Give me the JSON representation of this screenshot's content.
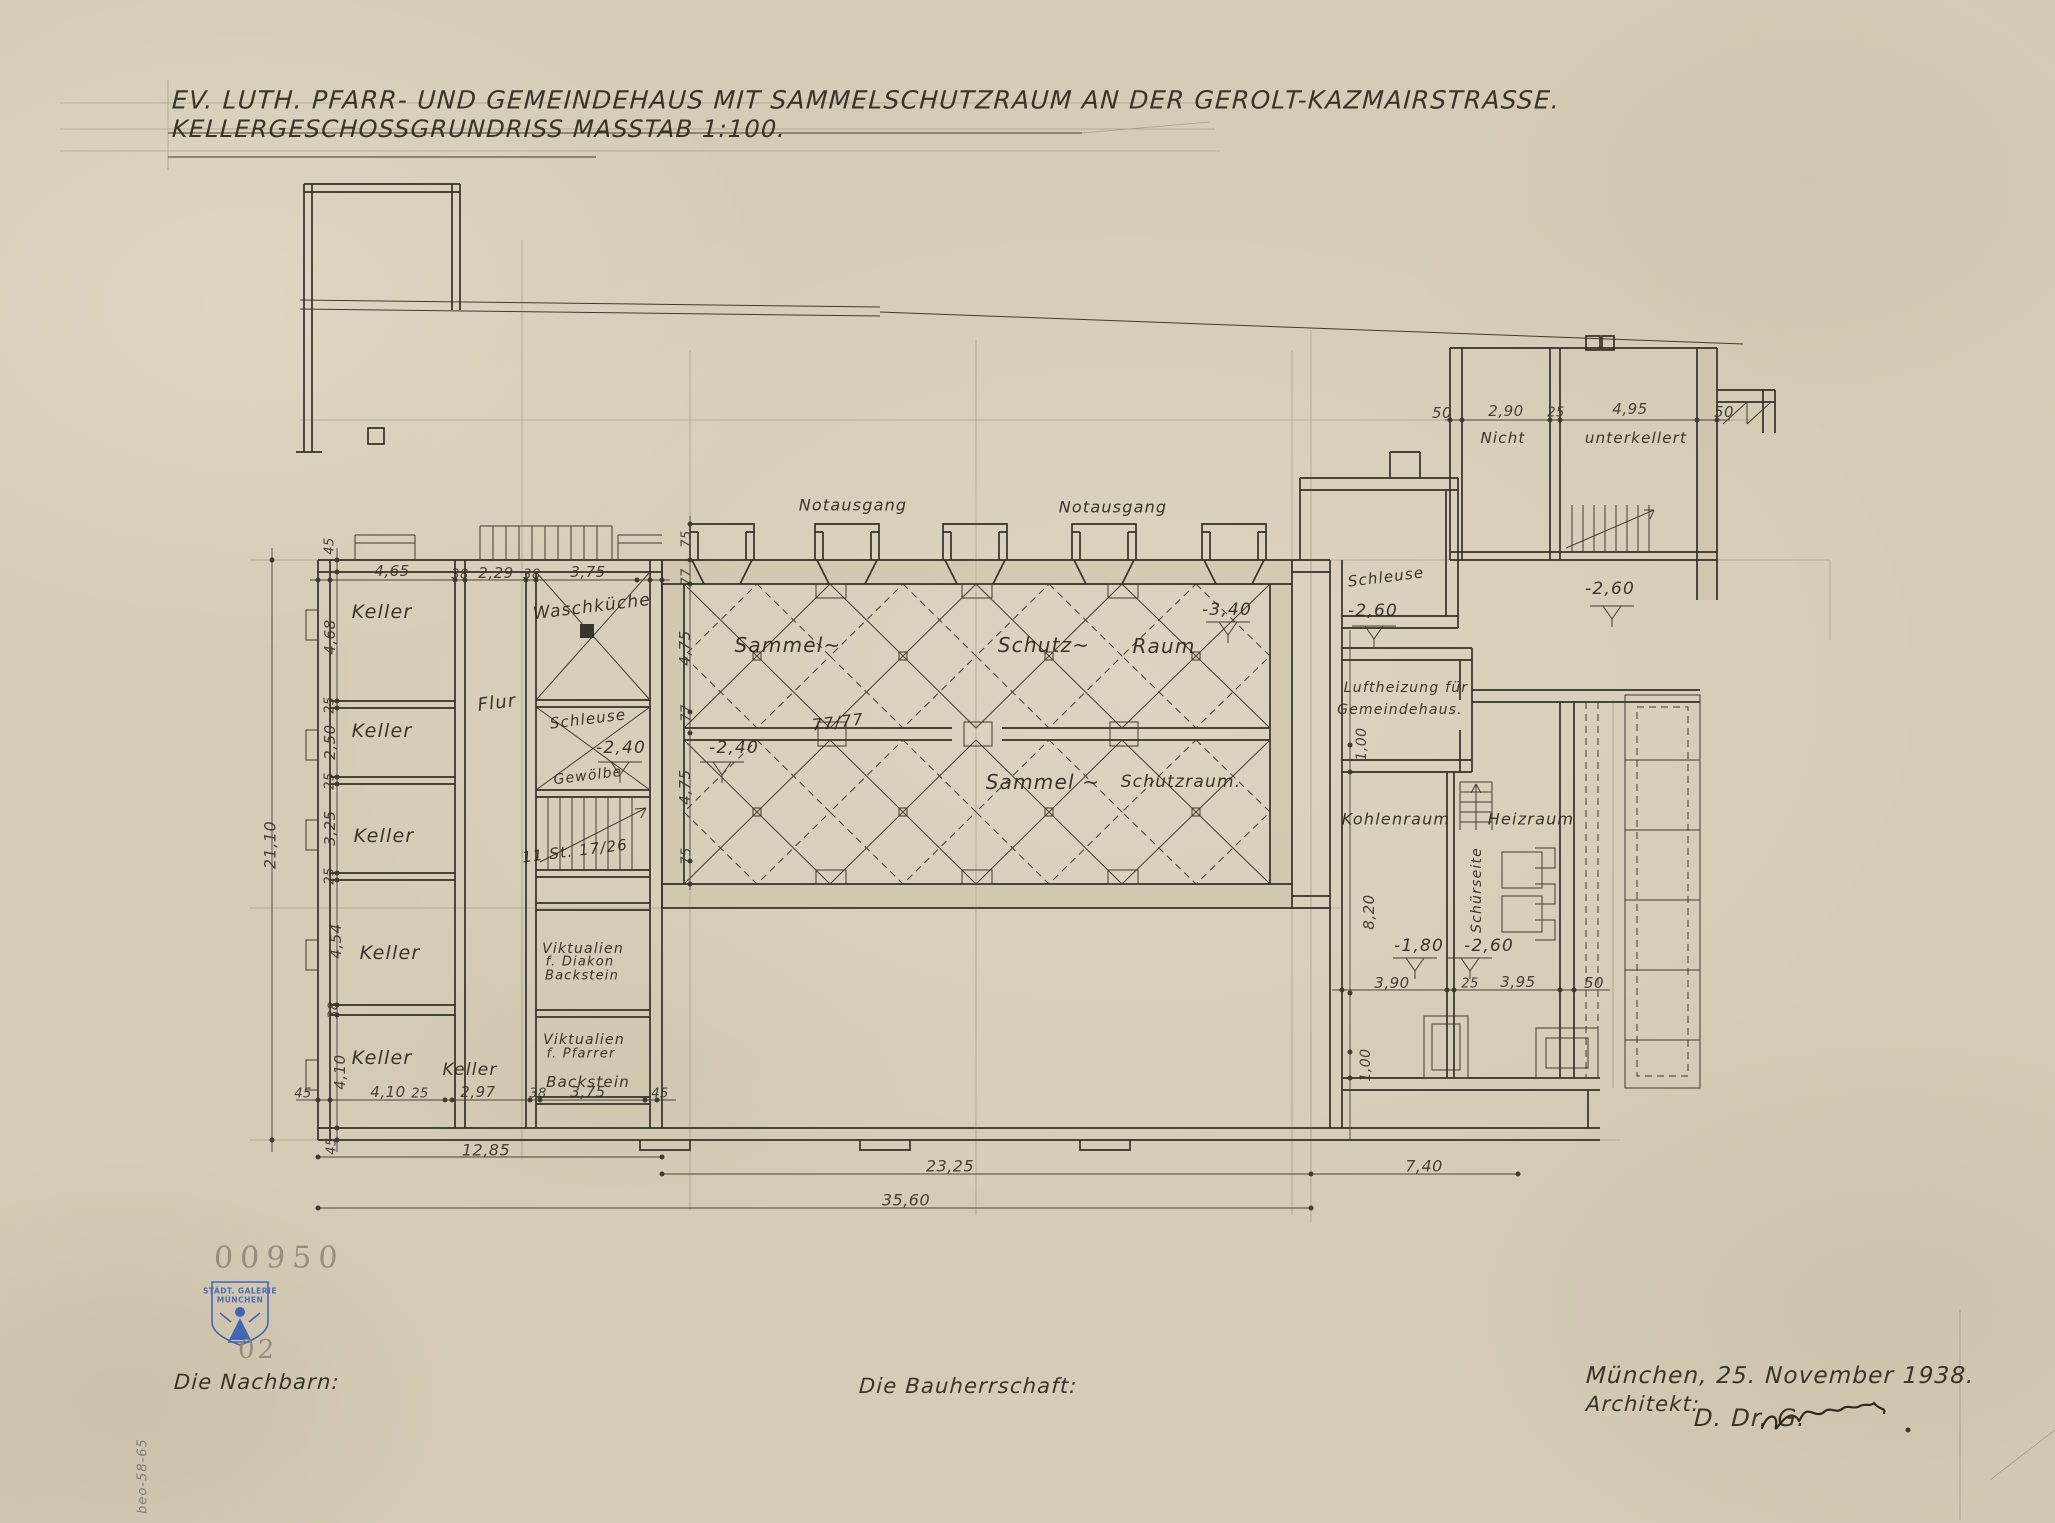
{
  "title": {
    "line1": "EV. LUTH. PFARR- UND GEMEINDEHAUS MIT SAMMELSCHUTZRAUM AN DER GEROLT-KAZMAIRSTRASSE.",
    "line2": "KELLERGESCHOSSGRUNDRISS    MASSTAB 1:100."
  },
  "rooms": {
    "keller": "Keller",
    "flur": "Flur",
    "waschkueche": "Waschküche",
    "schleuse": "Schleuse",
    "gewoelbe": "Gewölbe",
    "stairs_note": "11 St. 17/26",
    "viktualien": "Viktualien",
    "f_diakon": "f. Diakon",
    "f_pfarrer": "f. Pfarrer",
    "backstein": "Backstein",
    "sammel": "Sammel~",
    "schutz": "Schutz~",
    "raum": "Raum",
    "sammel2": "Sammel ~",
    "schutzraum": "Schutzraum.",
    "notausgang": "Notausgang",
    "vault": "77/77",
    "luftheizung1": "Luftheizung für",
    "luftheizung2": "Gemeindehaus.",
    "kohlenraum": "Kohlenraum",
    "heizraum": "Heizraum",
    "schuerseite": "Schürseite",
    "nicht": "Nicht",
    "unterkellert": "unterkellert"
  },
  "levels": {
    "m240": "-2,40",
    "m340": "-3,40",
    "m260": "-2,60",
    "m180": "-1,80"
  },
  "dims": {
    "d45": "45",
    "d38": "38",
    "d25": "25",
    "d75": "75",
    "d77": "77",
    "d465": "4,65",
    "d229": "2,29",
    "d375": "3,75",
    "d468": "4,68",
    "d250": "2,50",
    "d325": "3,25",
    "d454": "4,54",
    "d410": "4,10",
    "d297": "2,97",
    "d475": "4,75",
    "d2110": "21,10",
    "d1285": "12,85",
    "d2325": "23,25",
    "d740": "7,40",
    "d3560": "35,60",
    "d50": "50",
    "d290": "2,90",
    "d495": "4,95",
    "d100": "1,00",
    "d820": "8,20",
    "d390": "3,90",
    "d395": "3,95"
  },
  "stamps": {
    "number": "00950",
    "galerie1": "STÄDT. GALERIE",
    "galerie2": "MÜNCHEN",
    "sub": "02",
    "margin": "beo-58-65"
  },
  "footer": {
    "nachbarn": "Die Nachbarn:",
    "bauherrschaft": "Die Bauherrschaft:",
    "date": "München, 25. November 1938.",
    "architekt": "Architekt:",
    "signature": "D. Dr. G."
  },
  "colors": {
    "paper": "#d5ccb7",
    "ink": "#35302a",
    "pencil": "#7d776b",
    "stamp_blue": "#4366b4"
  }
}
